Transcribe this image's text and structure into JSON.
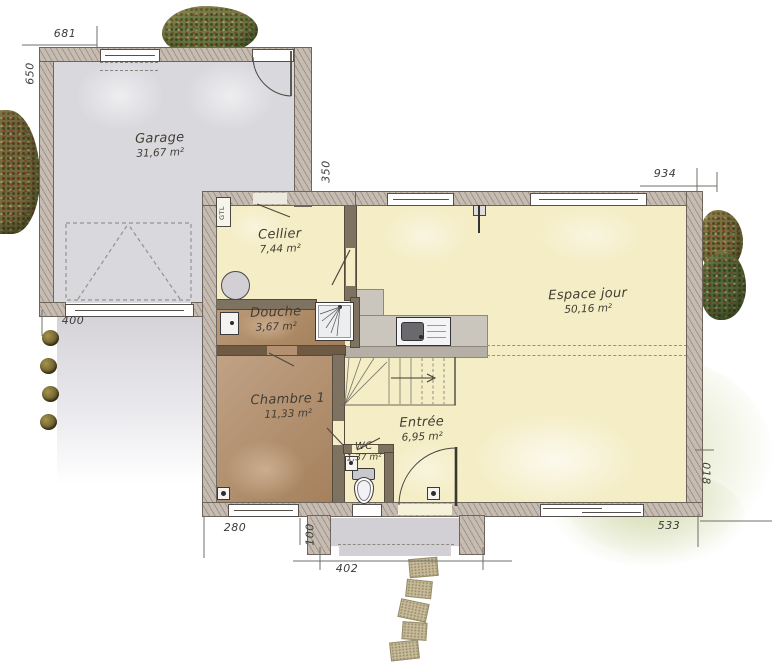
{
  "plan": {
    "rooms": {
      "garage": {
        "name": "Garage",
        "area": "31,67 m²"
      },
      "cellier": {
        "name": "Cellier",
        "area": "7,44 m²"
      },
      "douche": {
        "name": "Douche",
        "area": "3,67 m²"
      },
      "chambre": {
        "name": "Chambre 1",
        "area": "11,33 m²"
      },
      "espace_jour": {
        "name": "Espace jour",
        "area": "50,16 m²"
      },
      "entree": {
        "name": "Entrée",
        "area": "6,95 m²"
      },
      "wc": {
        "name": "WC",
        "area": "1,37 m²"
      }
    },
    "annotations": {
      "gtl": "GTL"
    },
    "dimensions": {
      "garage_width": "681",
      "garage_depth": "650",
      "garage_house_offset": "350",
      "house_width": "934",
      "garage_door": "400",
      "chambre_window": "280",
      "entry_offset": "100",
      "porch_width": "402",
      "bay_window": "533",
      "right_offset": "018"
    },
    "colors": {
      "wall": "#c6bcb2",
      "garage_floor": "#d9d8dd",
      "living_floor": "#f4edc5",
      "bedroom_floor": "#a5805c",
      "terrace": "#d6ddaf",
      "tree": "#6d7743"
    }
  }
}
